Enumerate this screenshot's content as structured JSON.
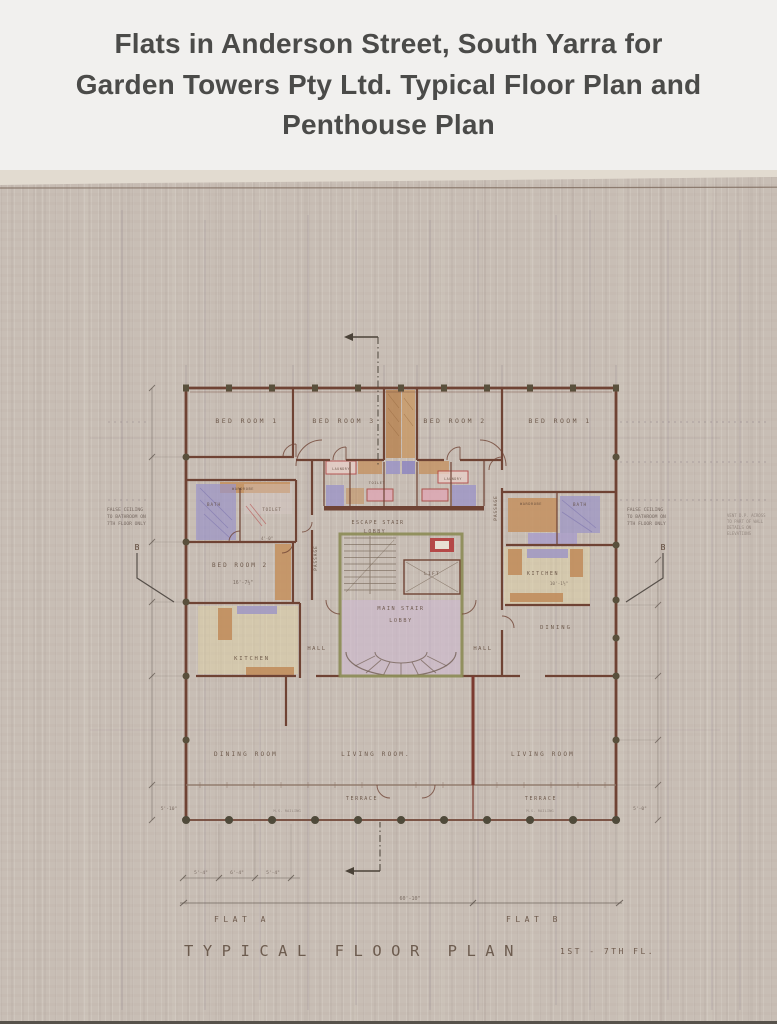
{
  "header": {
    "title": "Flats in Anderson Street, South Yarra for Garden Towers Pty Ltd. Typical Floor Plan and Penthouse Plan"
  },
  "plan": {
    "rooms": {
      "bedroom1_a": "BED ROOM 1",
      "bedroom3": "BED ROOM 3",
      "bedroom2_top": "BED ROOM 2",
      "bedroom1_b": "BED ROOM 1",
      "bedroom2_a": "BED ROOM 2",
      "kitchen_a": "KITCHEN",
      "kitchen_b": "KITCHEN",
      "dining_room": "DINING ROOM",
      "dining_b": "DINING",
      "living_room_a": "LIVING ROOM.",
      "living_room_b": "LIVING ROOM",
      "terrace_a": "TERRACE",
      "terrace_b": "TERRACE",
      "hall_a": "HALL",
      "hall_b": "HALL",
      "passage_a": "PASSAGE",
      "passage_b": "PASSAGE",
      "main_stair_1": "MAIN STAIR",
      "main_stair_2": "LOBBY",
      "escape_stair_1": "ESCAPE STAIR",
      "escape_stair_2": "LOBBY",
      "lift": "LIFT",
      "bath_a": "BATH",
      "toilet_a": "TOILET",
      "toilet_c": "TOILET",
      "wardrobe_a": "WARDROBE",
      "bath_b": "BATH",
      "wardrobe_b": "WARDROBE",
      "laundry_a": "LAUNDRY",
      "laundry_b": "LAUNDRY"
    },
    "notes": {
      "false_ceiling_1": "FALSE CEILING",
      "false_ceiling_2": "TO BATHROOM ON",
      "false_ceiling_3": "7TH FLOOR ONLY",
      "side_note_1": "VENT D.P. ACROSS",
      "side_note_2": "TO PART OF WALL",
      "side_note_3": "DETAILS ON",
      "side_note_4": "ELEVATIONS",
      "railing": "M.S. RAILING",
      "section_b": "B"
    },
    "dims": {
      "overall": "60'-10\"",
      "bed2": "16'-7½\"",
      "kitchen_b": "10'-1½\"",
      "bath": "4'-0\"",
      "d1": "5'-4\"",
      "d2": "6'-4\"",
      "d3": "5'-4\"",
      "left": "5'-10\"",
      "right": "5'-0\""
    },
    "titles": {
      "flat_a": "FLAT A",
      "flat_b": "FLAT B",
      "plan_title": "TYPICAL FLOOR PLAN",
      "plan_floors": "1ST - 7TH FL."
    },
    "palette": {
      "paper": "#c8beb5",
      "wall_brown": "#6f4334",
      "core_green": "#8b8b54",
      "timber_tan": "#c49262",
      "bath_blue": "#9b94c6",
      "lobby_lavender": "#cdb9cd",
      "kitchen_cream": "#e0d2a6",
      "accent_red": "#b23c3c",
      "ink": "#5b4536"
    }
  }
}
